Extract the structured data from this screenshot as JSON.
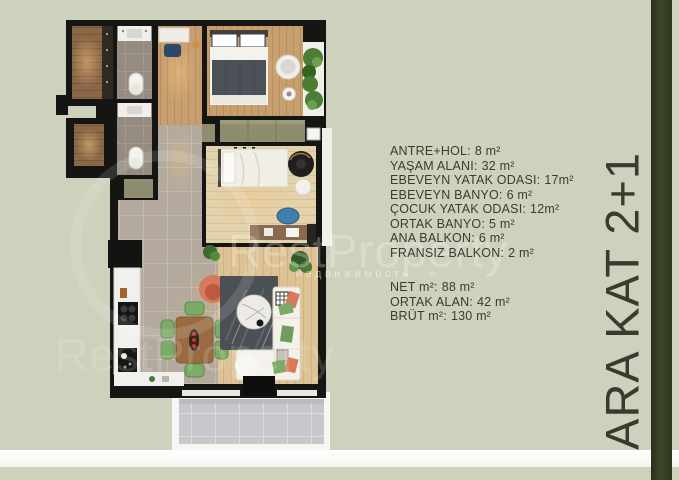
{
  "floor_label": "ARA KAT 2+1",
  "watermark": {
    "brand": "RestProperty",
    "subtitle": "недвижимость",
    "mark": "®"
  },
  "area_list": [
    {
      "label": "ANTRE+HOL:",
      "value": "8 m²"
    },
    {
      "label": "YAŞAM ALANI:",
      "value": "32 m²"
    },
    {
      "label": "EBEVEYN YATAK ODASI:",
      "value": "17m²"
    },
    {
      "label": "EBEVEYN BANYO:",
      "value": "6 m²"
    },
    {
      "label": "ÇOCUK YATAK ODASI:",
      "value": "12m²"
    },
    {
      "label": "ORTAK BANYO:",
      "value": "5 m²"
    },
    {
      "label": "ANA BALKON:",
      "value": "6 m²"
    },
    {
      "label": "FRANSIZ BALKON:",
      "value": "2 m²"
    }
  ],
  "summary_list": [
    {
      "label": "NET m²:",
      "value": "88 m²"
    },
    {
      "label": "ORTAK ALAN:",
      "value": "42 m²"
    },
    {
      "label": "BRÜT m²:",
      "value": "130 m²"
    }
  ],
  "palette": {
    "background": "#ccd2bc",
    "accent_bar": "#353c22",
    "text": "#3b3c31",
    "plan_walls": "#151513",
    "wood_floor": "#c79e6e",
    "pale_wood": "#e3d2ac",
    "tile_floor": "#b3a99d",
    "balcony_tile": "#c9c7cc",
    "sofa_white": "#f3f1ea",
    "chair_green": "#7cab67",
    "armchair_coral": "#d9795b",
    "khaki_furniture": "#8f8c70",
    "bottom_strip": "#fbfbf9"
  }
}
